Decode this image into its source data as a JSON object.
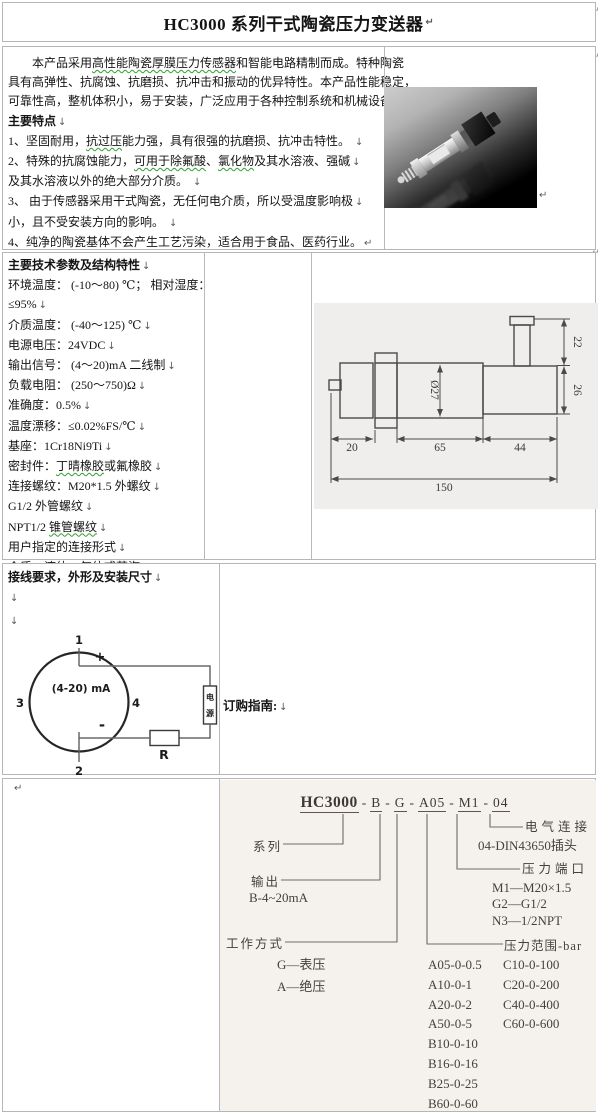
{
  "colors": {
    "table_border": "#b6b6b6",
    "spellcheck_wavy": "#2f9e2f",
    "scan_background": "#f5f2ee",
    "drawing_background": "#efeeec"
  },
  "title": {
    "text": "HC3000 系列干式陶瓷压力变送器",
    "mark": "↵"
  },
  "edge_marks": [
    "↵",
    "↵",
    "↵"
  ],
  "photo_mark": "↵",
  "overview": {
    "lines": [
      [
        {
          "t": "　　本产品采用"
        },
        {
          "t": "高性能陶瓷厚膜压力传感器",
          "w": 1
        },
        {
          "t": "和智能电路精制而成。特种陶瓷"
        }
      ],
      [
        {
          "t": "具有高弹性、抗腐蚀、抗磨损、抗冲击和振动的优异特性。本产品性能稳定，"
        }
      ],
      [
        {
          "t": "可靠性高，整机体积小，易于安装，广泛应用于各种控制系统和机械设备中。"
        }
      ],
      [
        {
          "t": "主要特点",
          "b": 1
        },
        {
          "t": "↓",
          "m": 1
        }
      ],
      [
        {
          "t": "1、坚固耐用，"
        },
        {
          "t": "抗过压",
          "w": 1
        },
        {
          "t": "能力强，具有很强的抗磨损、抗冲击特性。 "
        },
        {
          "t": "↓",
          "m": 1
        }
      ],
      [
        {
          "t": "2、特殊的抗腐蚀能力，"
        },
        {
          "t": "可用于除氟酸",
          "w": 1
        },
        {
          "t": "、"
        },
        {
          "t": "氯化物",
          "w": 1
        },
        {
          "t": "及其水溶液、强碱"
        },
        {
          "t": "↓",
          "m": 1
        }
      ],
      [
        {
          "t": "及其水溶液以外的绝大部分介质。 "
        },
        {
          "t": "↓",
          "m": 1
        }
      ],
      [
        {
          "t": "3、 由于传感器采用干式陶瓷，无任何电介质，所以受温度影响极"
        },
        {
          "t": "↓",
          "m": 1
        }
      ],
      [
        {
          "t": "小，且不受安装方向的影响。 "
        },
        {
          "t": "↓",
          "m": 1
        }
      ],
      [
        {
          "t": "4、纯净的陶瓷基体不会产生工艺污染，适合用于食品、医药行业。"
        },
        {
          "t": "↵",
          "m": 1
        }
      ]
    ]
  },
  "specs": {
    "lines": [
      [
        {
          "t": "主要技术参数及结构特性",
          "b": 1
        },
        {
          "t": "↓",
          "m": 1
        }
      ],
      [
        {
          "t": "环境温度： (-10～80) ℃；  相对湿度："
        }
      ],
      [
        {
          "t": "≤95%"
        },
        {
          "t": "↓",
          "m": 1
        }
      ],
      [
        {
          "t": "介质温度： (-40～125) ℃"
        },
        {
          "t": "↓",
          "m": 1
        }
      ],
      [
        {
          "t": "电源电压：24VDC"
        },
        {
          "t": "↓",
          "m": 1
        }
      ],
      [
        {
          "t": "输出信号： (4～20)mA 二线制"
        },
        {
          "t": "↓",
          "m": 1
        }
      ],
      [
        {
          "t": "负载电阻： (250～750)Ω"
        },
        {
          "t": "↓",
          "m": 1
        }
      ],
      [
        {
          "t": "准确度：0.5%"
        },
        {
          "t": "↓",
          "m": 1
        }
      ],
      [
        {
          "t": "温度漂移：≤0.02%FS/℃"
        },
        {
          "t": "↓",
          "m": 1
        }
      ],
      [
        {
          "t": "基座：1Cr18Ni9Ti"
        },
        {
          "t": "↓",
          "m": 1
        }
      ],
      [
        {
          "t": "密封件："
        },
        {
          "t": "丁晴橡胶",
          "w": 1
        },
        {
          "t": "或氟橡胶"
        },
        {
          "t": "↓",
          "m": 1
        }
      ],
      [
        {
          "t": "连接螺纹：M20*1.5 外螺纹"
        },
        {
          "t": "↓",
          "m": 1
        }
      ],
      [
        {
          "t": "G1/2 外管螺纹"
        },
        {
          "t": "↓",
          "m": 1
        }
      ],
      [
        {
          "t": "NPT1/2 "
        },
        {
          "t": "锥管螺纹",
          "w": 1
        },
        {
          "t": "↓",
          "m": 1
        }
      ],
      [
        {
          "t": "用户指定的连接形式"
        },
        {
          "t": "↓",
          "m": 1
        }
      ],
      [
        {
          "t": "介质：液体、气体或蒸汽"
        },
        {
          "t": "↵",
          "m": 1
        }
      ]
    ]
  },
  "drawing": {
    "dia": "Ø27",
    "h22": "22",
    "h26": "26",
    "w20": "20",
    "w65": "65",
    "w44": "44",
    "w150": "150"
  },
  "wiring": {
    "heading": "接线要求，外形及安装尺寸",
    "heading_mark": "↓",
    "breaks": [
      "↓",
      "↓"
    ],
    "t1": "1",
    "t2": "2",
    "t3": "3",
    "t4": "4",
    "signal": "(4-20) mA",
    "plus": "+",
    "minus": "-",
    "supply_top": "电",
    "supply_bottom": "源",
    "resistor": "R"
  },
  "order_heading": {
    "text": "订购指南:",
    "mark": "↓"
  },
  "ordering": {
    "left_mark": "↵",
    "model_parts": [
      {
        "t": "HC3000",
        "b": 1,
        "u": 1
      },
      {
        "t": "-"
      },
      {
        "t": "B",
        "u": 1
      },
      {
        "t": "-"
      },
      {
        "t": "G",
        "u": 1
      },
      {
        "t": "-"
      },
      {
        "t": "A05",
        "u": 1
      },
      {
        "t": "-"
      },
      {
        "t": "M1",
        "u": 1
      },
      {
        "t": "-"
      },
      {
        "t": "04",
        "u": 1
      }
    ],
    "series_label": "系列",
    "output_label": "输出",
    "output_value": "B-4~20mA",
    "mode_label": "工作方式",
    "mode_options": [
      "G—表压",
      "A—绝压"
    ],
    "elec_label": "电气连接",
    "elec_value": "04-DIN43650插头",
    "port_label": "压力端口",
    "port_options": [
      "M1—M20×1.5",
      "G2—G1/2",
      "N3—1/2NPT"
    ],
    "range_label": "压力范围-bar",
    "range_col1": [
      "A05-0-0.5",
      "A10-0-1",
      "A20-0-2",
      "A50-0-5",
      "B10-0-10",
      "B16-0-16",
      "B25-0-25",
      "B60-0-60"
    ],
    "range_col2": [
      "C10-0-100",
      "C20-0-200",
      "C40-0-400",
      "C60-0-600"
    ]
  }
}
